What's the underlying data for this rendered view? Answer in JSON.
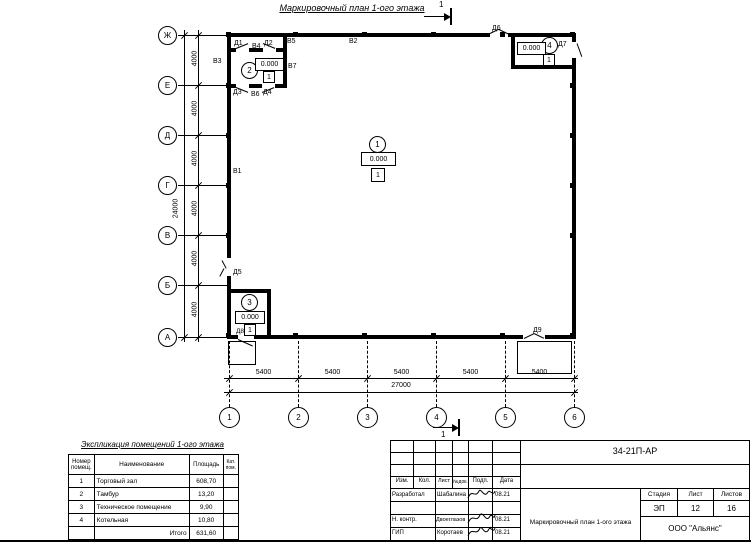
{
  "plan_title": "Маркировочный план 1-ого этажа",
  "section_mark": "1",
  "axes": {
    "horizontal": [
      "Ж",
      "Е",
      "Д",
      "Г",
      "В",
      "Б",
      "А"
    ],
    "vertical": [
      "1",
      "2",
      "3",
      "4",
      "5",
      "6"
    ],
    "dim_left_segments": [
      "4000",
      "4000",
      "4000",
      "4000",
      "4000",
      "4000"
    ],
    "dim_left_total": "24000",
    "dim_bottom_segments": [
      "5400",
      "5400",
      "5400",
      "5400",
      "5400"
    ],
    "dim_bottom_total": "27000"
  },
  "rooms": [
    {
      "number": "1",
      "elevation": "0.000",
      "floor": "1"
    },
    {
      "number": "2",
      "elevation": "0.000",
      "floor": "1"
    },
    {
      "number": "3",
      "elevation": "0.000",
      "floor": "1"
    },
    {
      "number": "4",
      "elevation": "0.000",
      "floor": "1"
    }
  ],
  "marks": {
    "d1": "Д1",
    "d2": "Д2",
    "d3": "Д3",
    "d4": "Д4",
    "d5": "Д5",
    "d6": "Д6",
    "d7": "Д7",
    "d8": "Д8",
    "d9": "Д9",
    "v1": "В1",
    "v2": "В2",
    "v3": "В3",
    "v4": "В4",
    "v5": "В5",
    "v6": "В6",
    "v7": "В7"
  },
  "explication": {
    "title": "Экспликация помещений 1-ого этажа",
    "col_num": "Номер помещ.",
    "col_name": "Наименование",
    "col_area": "Площадь",
    "col_cat": "Кат. пом.",
    "rows": [
      {
        "num": "1",
        "name": "Торговый зал",
        "area": "608,70",
        "cat": ""
      },
      {
        "num": "2",
        "name": "Тамбур",
        "area": "13,20",
        "cat": ""
      },
      {
        "num": "3",
        "name": "Техническое помещение",
        "area": "9,90",
        "cat": ""
      },
      {
        "num": "4",
        "name": "Котельная",
        "area": "10,80",
        "cat": ""
      }
    ],
    "total_label": "Итого",
    "total_value": "631,60"
  },
  "titleblock": {
    "doc_number": "34-21П-АР",
    "col_izm": "Изм.",
    "col_kol": "Кол.",
    "col_list": "Лист",
    "col_ndok": "№док.",
    "col_podp": "Подп.",
    "col_data": "Дата",
    "roles": [
      {
        "role": "Разработал",
        "name": "Шабалина",
        "date": "08.21"
      },
      {
        "role": "Н. контр.",
        "name": "Двоеглазов",
        "date": "08.21"
      },
      {
        "role": "ГИП",
        "name": "Коротаев",
        "date": "08.21"
      }
    ],
    "stage_label": "Стадия",
    "sheet_label": "Лист",
    "sheets_label": "Листов",
    "stage": "ЭП",
    "sheet": "12",
    "sheets": "16",
    "drawing_title": "Маркировочный план 1-ого этажа",
    "company": "ООО \"Альянс\""
  }
}
